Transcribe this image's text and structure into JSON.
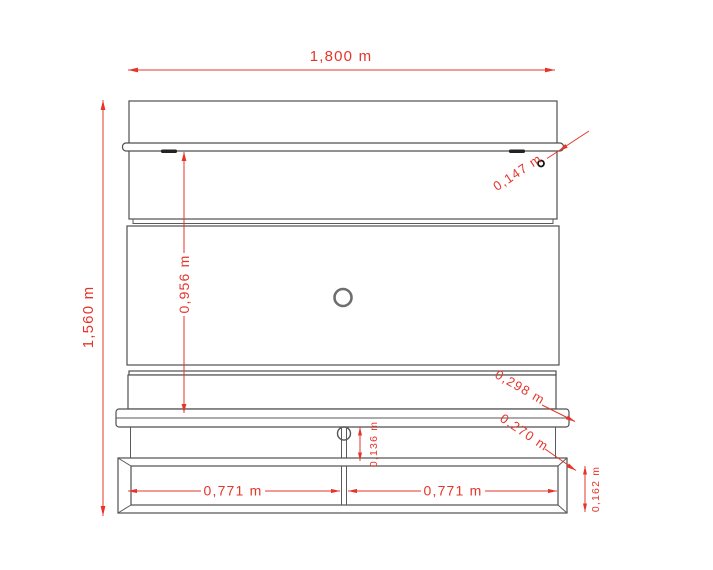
{
  "drawing": {
    "kind": "wall-panel-elevation-technical-drawing",
    "unit": "m",
    "colors": {
      "dimension_red": "#e5352b",
      "outline_gray": "#4f4f4f",
      "detail_black": "#1a1a1a",
      "background": "#ffffff"
    },
    "dimensions": {
      "overall_width": {
        "label": "1,800 m"
      },
      "overall_height": {
        "label": "1,560 m"
      },
      "panel_drop": {
        "label": "0,956 m"
      },
      "top_shelf_depth": {
        "label": "0,147 m"
      },
      "main_shelf_depth": {
        "label": "0,298 m"
      },
      "base_unit_depth": {
        "label": "0,270 m"
      },
      "hook_gap_height": {
        "label": "0,136 m"
      },
      "base_unit_height": {
        "label": "0,162 m"
      },
      "left_bay_width": {
        "label": "0,771 m"
      },
      "right_bay_width": {
        "label": "0,771 m"
      }
    },
    "details": [
      "top-shelf",
      "led-clip-left",
      "led-clip-right",
      "mounting-pin",
      "cable-hole",
      "main-shelf",
      "cable-hook-divider",
      "open-base-unit",
      "base-divider"
    ]
  }
}
